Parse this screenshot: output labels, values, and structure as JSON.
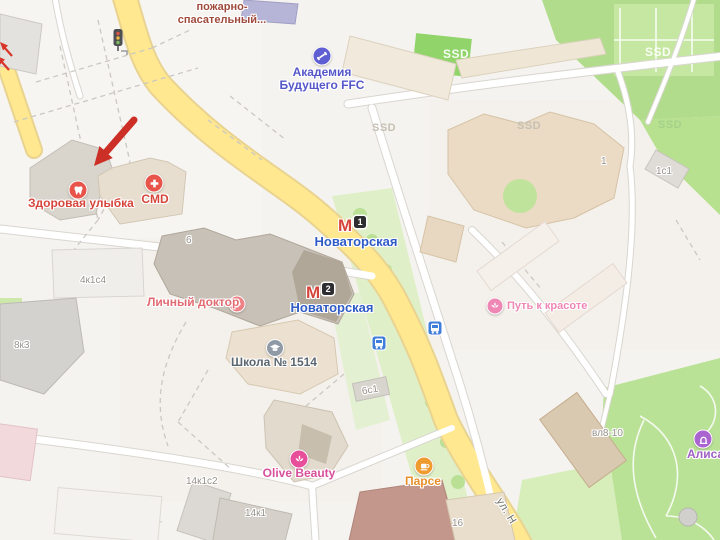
{
  "pois": {
    "fire_station": {
      "line1": "пожарно-",
      "line2": "спасательный...",
      "color": "#a04a3c"
    },
    "academy": {
      "line1": "Академия",
      "line2": "Будущего FFC",
      "color": "#5557c9",
      "icon_color": "#5f5fd3"
    },
    "healthy_smile": {
      "name": "Здоровая улыбка",
      "color": "#d6453c",
      "icon_color": "#e8544a"
    },
    "cmd": {
      "name": "CMD",
      "color": "#d6453c",
      "icon_color": "#e8544a"
    },
    "personal_doctor": {
      "name": "Личный доктор",
      "color": "#e26b72",
      "icon_color": "#ed8287"
    },
    "school": {
      "name": "Школа № 1514",
      "color": "#5b6670",
      "icon_color": "#8f9aa6"
    },
    "beauty_path": {
      "name": "Путь к красоте",
      "color": "#ef87b5",
      "icon_color": "#ef87b5"
    },
    "olive_beauty": {
      "name": "Olive Beauty",
      "color": "#d94f9b",
      "icon_color": "#e84f9b"
    },
    "parse": {
      "name": "Парсе",
      "color": "#e88f2a",
      "icon_color": "#f09b30"
    },
    "alisa": {
      "name": "Алиса",
      "color": "#a05fc4",
      "icon_color": "#a964cf"
    }
  },
  "metro": {
    "symbol": "М",
    "color": "#d6453c",
    "label_color": "#2f5bc7",
    "station1": {
      "name": "Новаторская",
      "exit": "1"
    },
    "station2": {
      "name": "Новаторская",
      "exit": "2"
    }
  },
  "building_numbers": [
    "6",
    "4к1с4",
    "8к3",
    "6с1",
    "14к1с2",
    "14к1",
    "16",
    "1",
    "1с1",
    "вл8-10"
  ],
  "area_labels": [
    "SSD",
    "SSD",
    "SSD",
    "SSD",
    "SSD"
  ],
  "street_labels": [
    "ул. Н"
  ],
  "palette": {
    "road_yellow": "#ffe88f",
    "park_green": "#b1dc8b",
    "light_green": "#dff0c9",
    "building_beige": "#ebdbc5",
    "annotation_red": "#cc2f26",
    "bus_blue": "#3f7ed8"
  }
}
